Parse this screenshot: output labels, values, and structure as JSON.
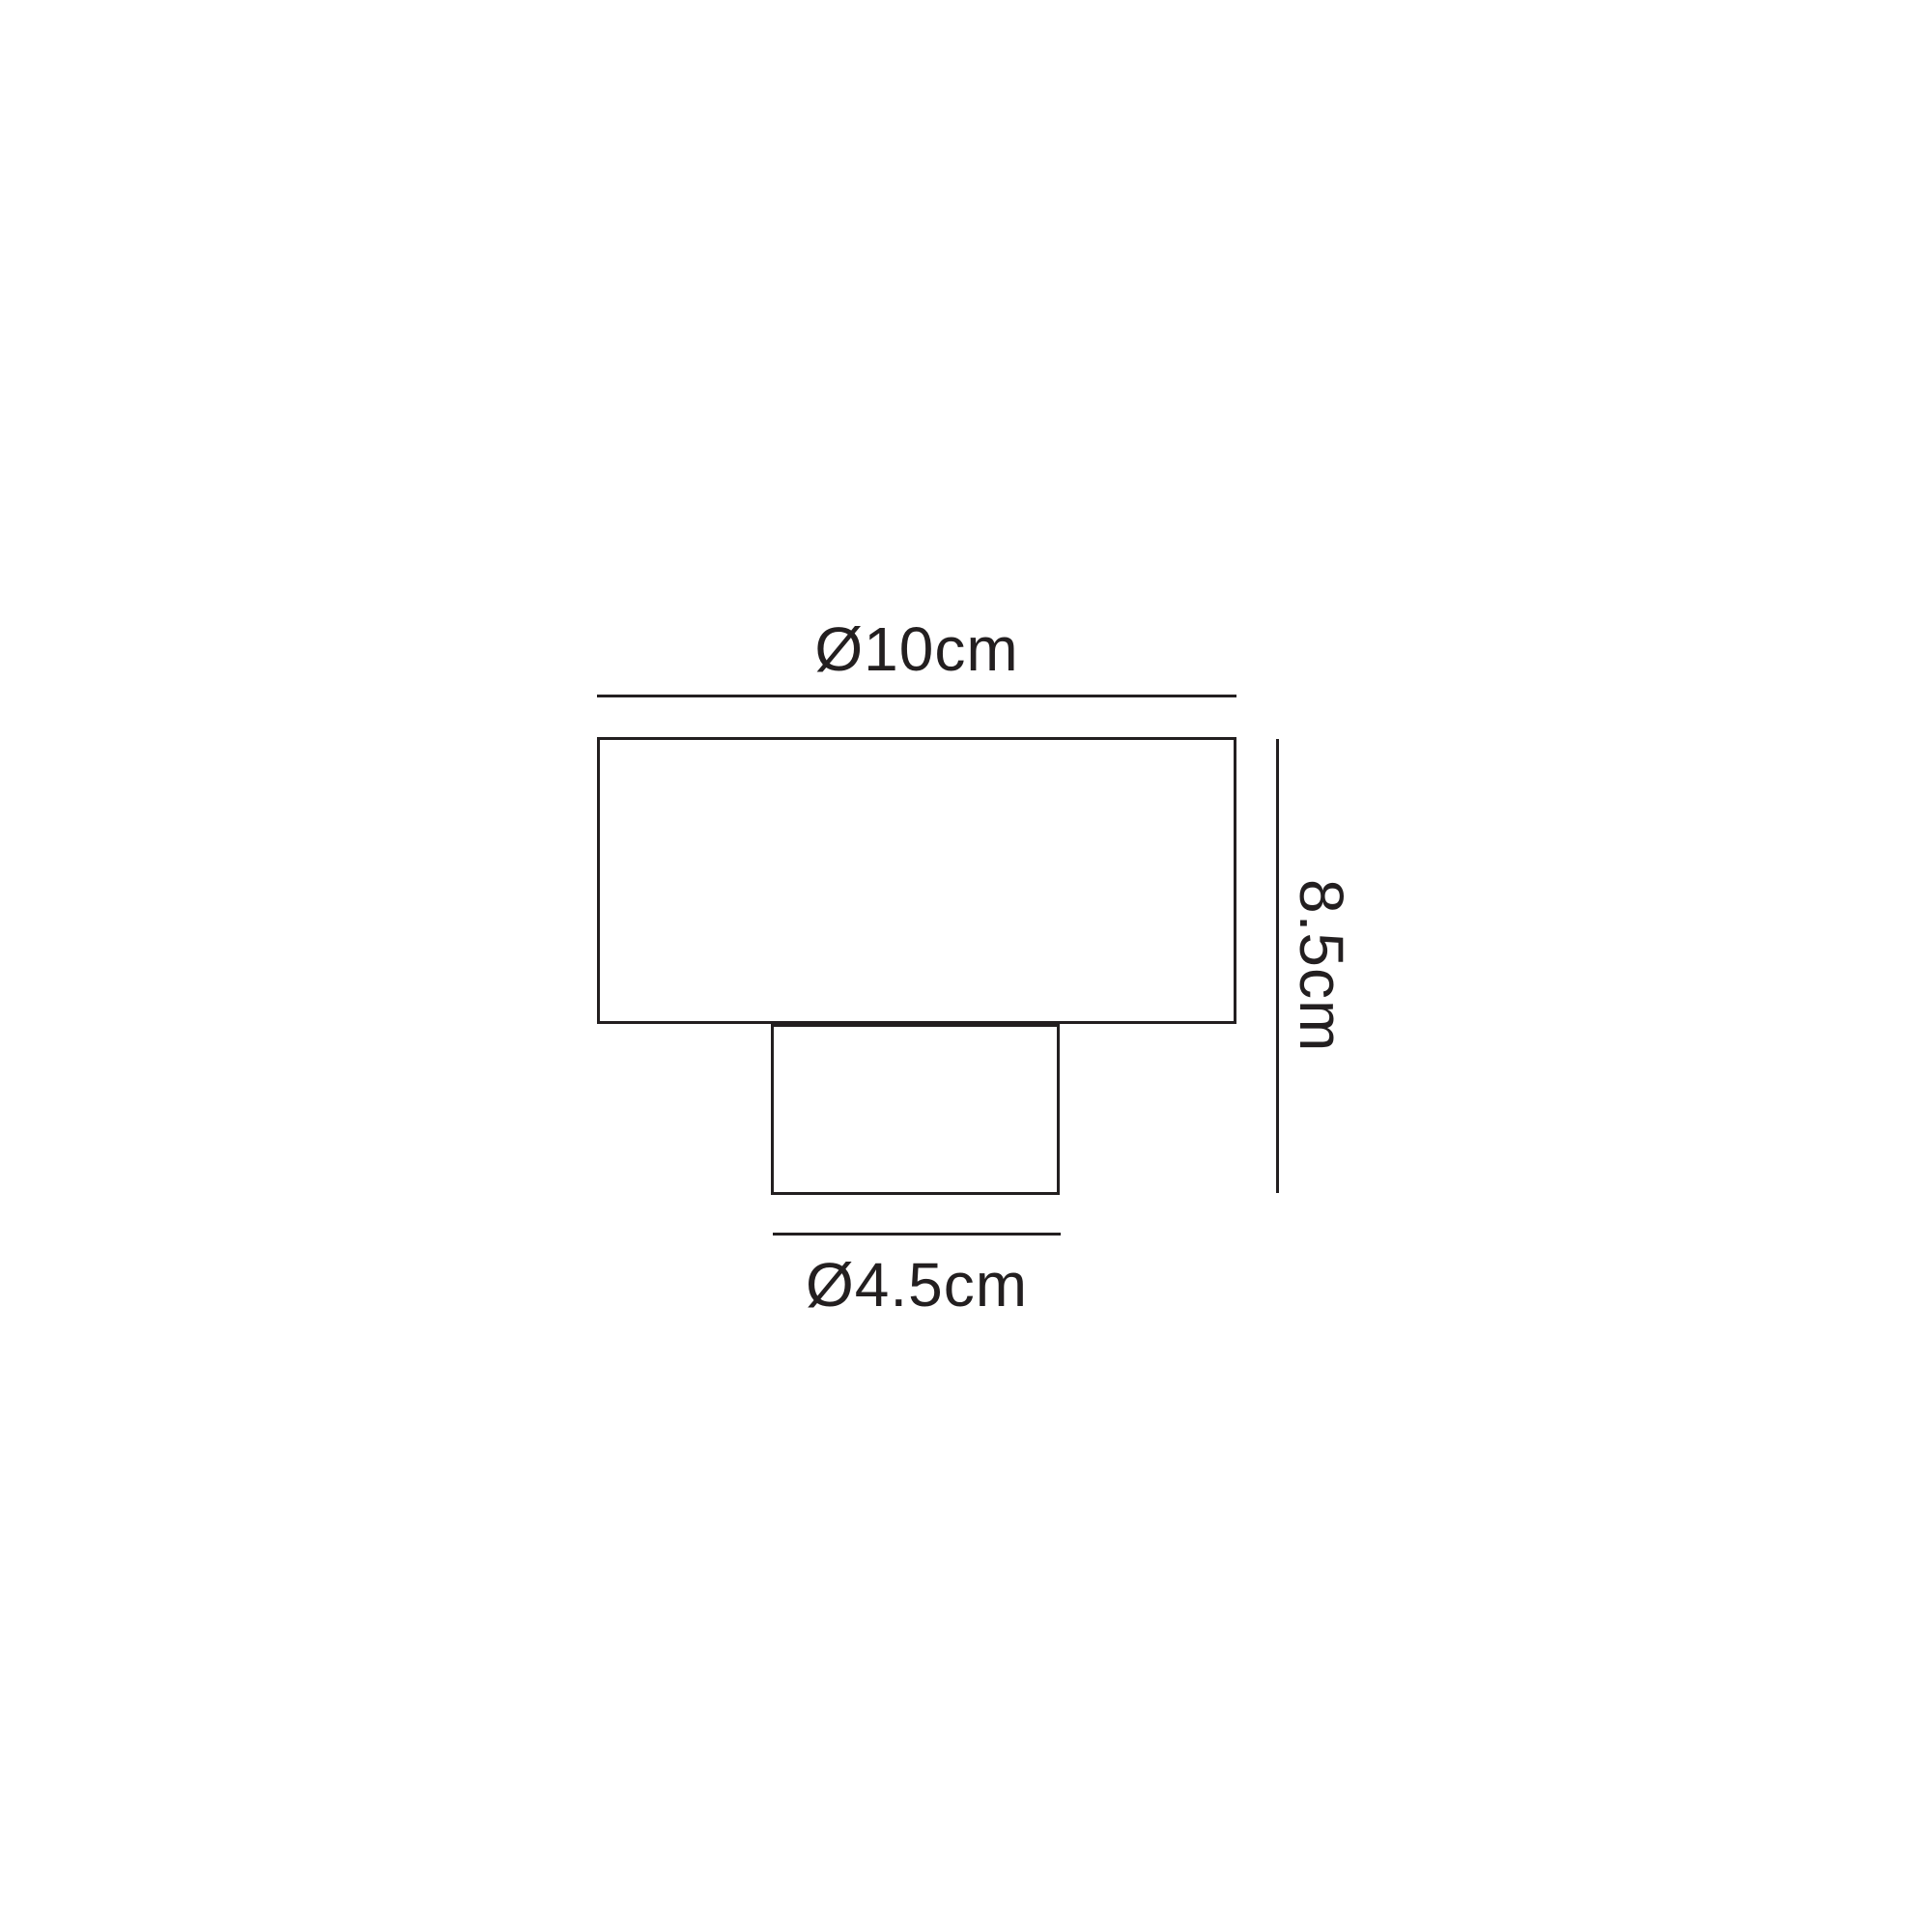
{
  "page": {
    "background_color": "#ffffff"
  },
  "diagram": {
    "kind": "product-dimension-drawing",
    "line_color": "#231f20",
    "dimensions": {
      "top_width_label": "Ø10cm",
      "side_height_label": "8.5cm",
      "bottom_width_label": "Ø4.5cm"
    }
  }
}
